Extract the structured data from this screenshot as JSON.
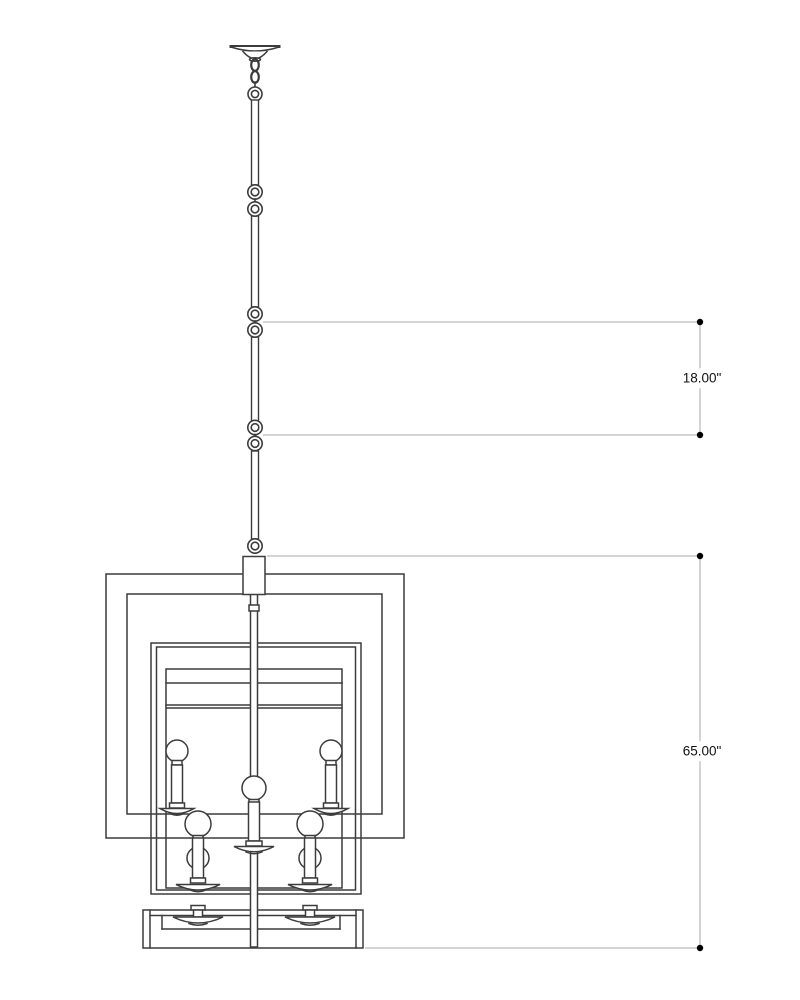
{
  "drawing": {
    "type": "product-dimension-elevation",
    "subject": "two-tier square lantern chandelier with chain and downrod",
    "background_color": "#ffffff",
    "fixture_line_color": "#3c3c3c",
    "dimension_line_color": "#a8a8a8",
    "dimension_marker_color": "#000000",
    "dimension_text_color": "#111111",
    "dimensions": {
      "chain": {
        "name": "chain-segment-length",
        "label": "18.00\"",
        "value_inches": 18.0
      },
      "overall": {
        "name": "fixture-overall-height",
        "label": "65.00\"",
        "value_inches": 65.0
      }
    }
  }
}
